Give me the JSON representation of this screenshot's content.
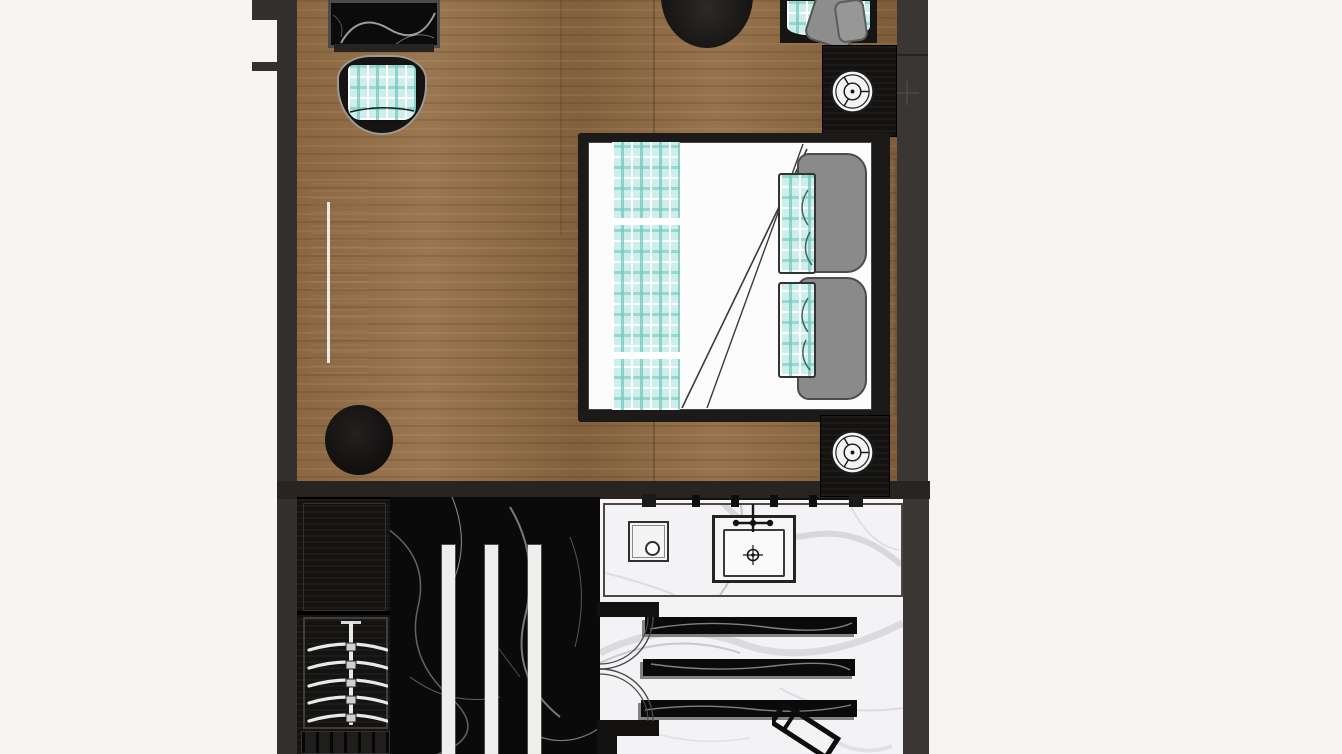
{
  "palette": {
    "page-bg": "#f7f4f2",
    "wall": "#33302e",
    "wall-light": "#3a3634",
    "divider": "#272422",
    "wood-a": "#96734c",
    "wood-b": "#7e5c3a",
    "wood-seam": "rgba(0,0,0,0.18)",
    "dark-furn": "#141312",
    "black-marble": "#0a0a0a",
    "white-marble": "#f3f2f4",
    "vein-white": "#dedede",
    "vein-gray": "#b8b5c0",
    "teal": "#cdeeea",
    "teal-stripe": "#74c7bf",
    "mattress": "#fcfcfc",
    "pillow": "#8a8a8a",
    "pillow-line": "#4c4c4c",
    "stripe-white": "#efeeec"
  },
  "floorplan": {
    "type": "hotel-guestroom-top-view-render",
    "rooms": [
      {
        "name": "bedroom",
        "floor": "wood-plank"
      },
      {
        "name": "bathroom",
        "floor": "black-and-white-marble"
      }
    ],
    "furniture": [
      "black-marble-side-table",
      "plaid-lounge-chair-left",
      "round-black-table",
      "plaid-lounge-chair-right-with-gray-throw",
      "nightstand-with-lamp-top",
      "tv-console",
      "round-ottoman",
      "bed-with-plaid-runner-two-gray-pillows-two-plaid-pillows",
      "nightstand-with-lamp-bottom",
      "wardrobe-with-hanger-rail-and-drawers",
      "black-marble-shower-floor-with-three-white-strips",
      "double-swing-door",
      "vanity-counter-with-sink-faucet-and-amenity-dish",
      "wall-hook-rail",
      "three-black-marble-benches",
      "angled-door-handle"
    ]
  }
}
